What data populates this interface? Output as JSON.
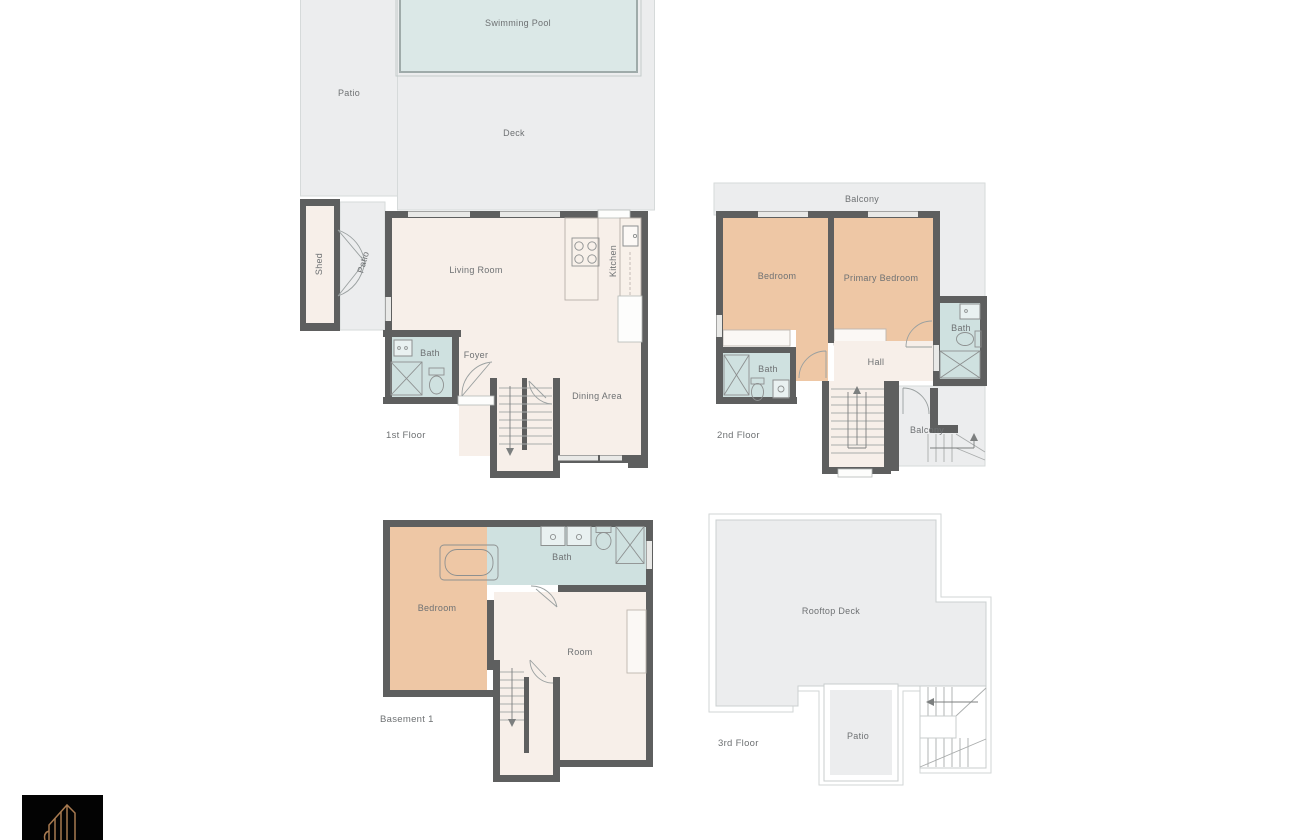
{
  "palette": {
    "wall": "#5e5f5f",
    "interior_floor": "#f7efe9",
    "bedroom_fill": "#eec7a5",
    "bathroom_fill": "#cfe1e0",
    "outdoor_fill": "#ecedee",
    "pool_fill": "#dbe8e7",
    "label_text": "#6e7173",
    "logo_background": "#030303",
    "logo_stroke": "#a87a50"
  },
  "floors": {
    "first": {
      "label": "1st Floor",
      "rooms": {
        "swimming_pool": "Swimming Pool",
        "patio": "Patio",
        "deck": "Deck",
        "shed": "Shed",
        "side_patio": "Patio",
        "living_room": "Living Room",
        "kitchen": "Kitchen",
        "bath": "Bath",
        "foyer": "Foyer",
        "dining_area": "Dining Area"
      }
    },
    "second": {
      "label": "2nd Floor",
      "rooms": {
        "balcony": "Balcony",
        "bedroom": "Bedroom",
        "primary_bedroom": "Primary Bedroom",
        "bath_left": "Bath",
        "bath_right": "Bath",
        "hall": "Hall",
        "rear_balcony": "Balcony"
      }
    },
    "basement": {
      "label": "Basement 1",
      "rooms": {
        "bedroom": "Bedroom",
        "bath": "Bath",
        "room": "Room"
      }
    },
    "third": {
      "label": "3rd Floor",
      "rooms": {
        "rooftop_deck": "Rooftop Deck",
        "patio": "Patio"
      }
    }
  },
  "logo": {
    "icon": "building-outline-icon"
  }
}
